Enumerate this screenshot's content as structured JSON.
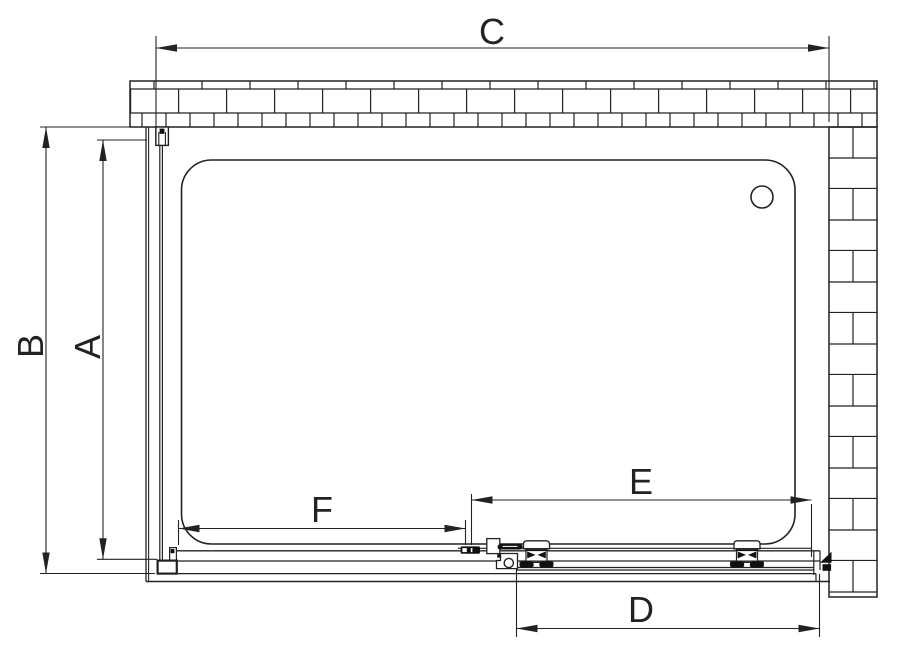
{
  "drawing": {
    "background": "#ffffff",
    "line_color": "#222222",
    "fill_dark": "#111111",
    "labels": {
      "c": "C",
      "b": "B",
      "a": "A",
      "f": "F",
      "e": "E",
      "d": "D"
    }
  }
}
